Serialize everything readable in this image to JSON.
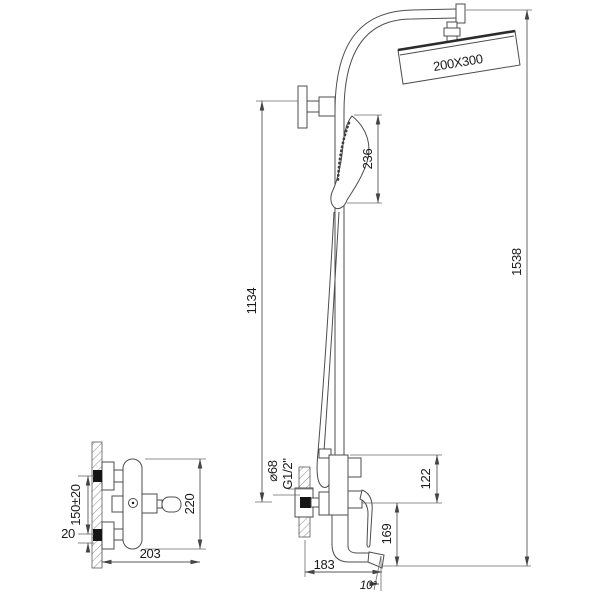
{
  "drawing": {
    "type": "technical-drawing",
    "subject": "shower column with rain head, hand shower and wall-mounted bath mixer",
    "colors": {
      "background": "#ffffff",
      "part_line": "#4d4d4d",
      "dimension_line": "#585858",
      "text": "#1a1a1a",
      "connector_fill": "#151515"
    },
    "dimensions": {
      "head_size": "200X300",
      "hand_shower_length": "236",
      "total_height": "1538",
      "riser_height": "1134",
      "escutcheon_diameter": "⌀68",
      "thread_size": "G1/2\"",
      "body_top_to_inlet": "122",
      "inlet_to_spout_tip": "169",
      "spout_reach": "183",
      "spout_angle": "10°",
      "connection_spacing": "150±20",
      "connection_offset": "20",
      "side_body_height": "220",
      "side_body_depth": "203"
    }
  }
}
